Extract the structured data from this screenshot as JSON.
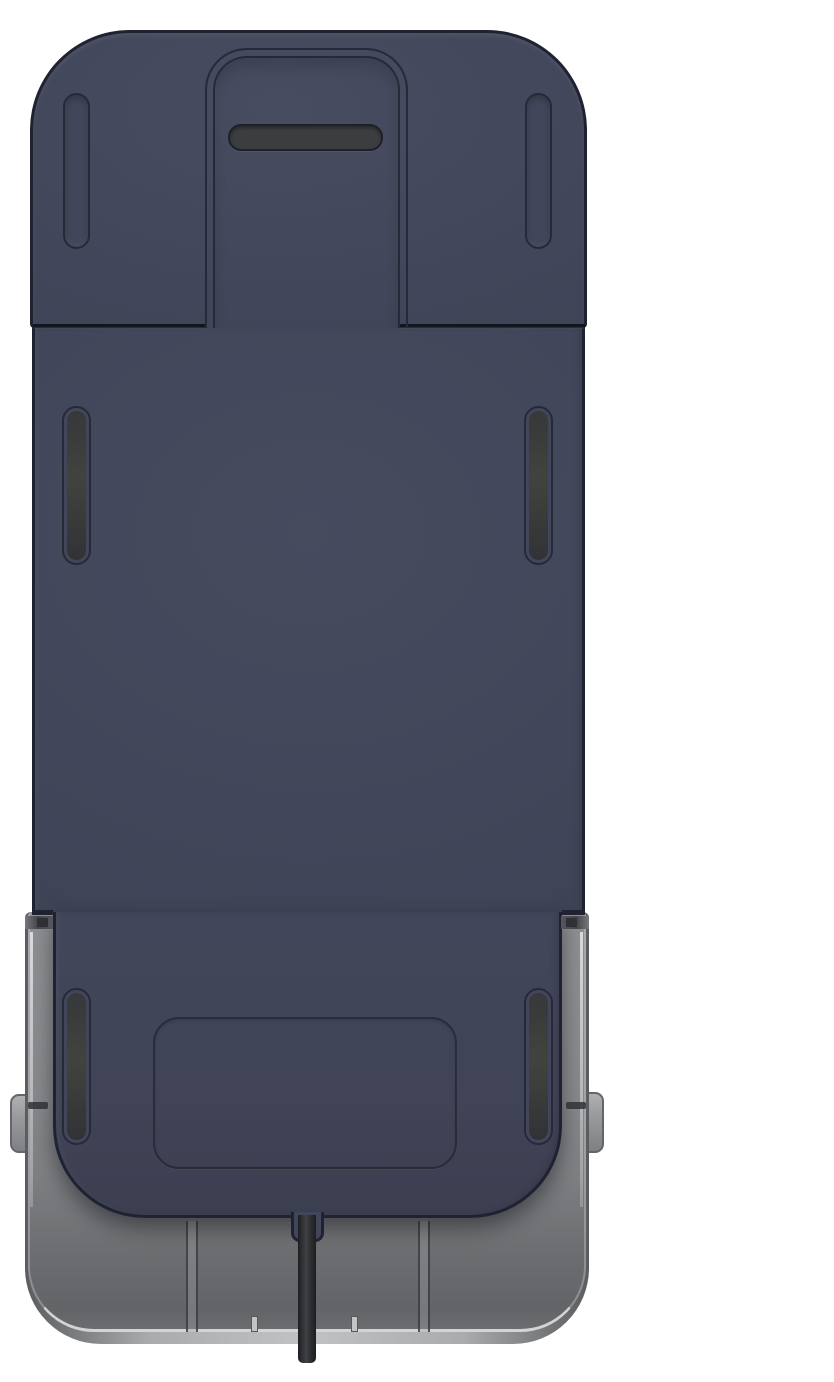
{
  "scene": {
    "kind": "3d-product-render",
    "description": "Rear view of a dark navy phone-mount cradle: top cap with center cutout and horizontal vent slot, tall main body with paired vertical side slots, blank label recess, translucent gray tray shell with side tabs, and a black cable exiting the bottom center",
    "visible_text": []
  },
  "theme": {
    "background": "#ffffff",
    "body": "#42465a",
    "bodyEdge": "#1f2230",
    "panelLine": "#262a38",
    "slotFill": "#3b3d3f",
    "trayRim": "#d2d4d6",
    "tabEdge": "#63656a"
  },
  "parts": {
    "cap": "top-cap",
    "cutout": "cap-center-cutout",
    "h_slot": "horizontal-vent-slot",
    "cap_slots": [
      "cap-slot-left",
      "cap-slot-right"
    ],
    "body": "main-back-plate",
    "mid_slots": [
      "middle-slot-left",
      "middle-slot-right"
    ],
    "low_slots": [
      "lower-slot-left",
      "lower-slot-right"
    ],
    "label": "label-recess",
    "tray": "gray-tray-shell",
    "tabs": [
      "tray-tab-left",
      "tray-tab-right"
    ],
    "cable": "power-cable"
  }
}
